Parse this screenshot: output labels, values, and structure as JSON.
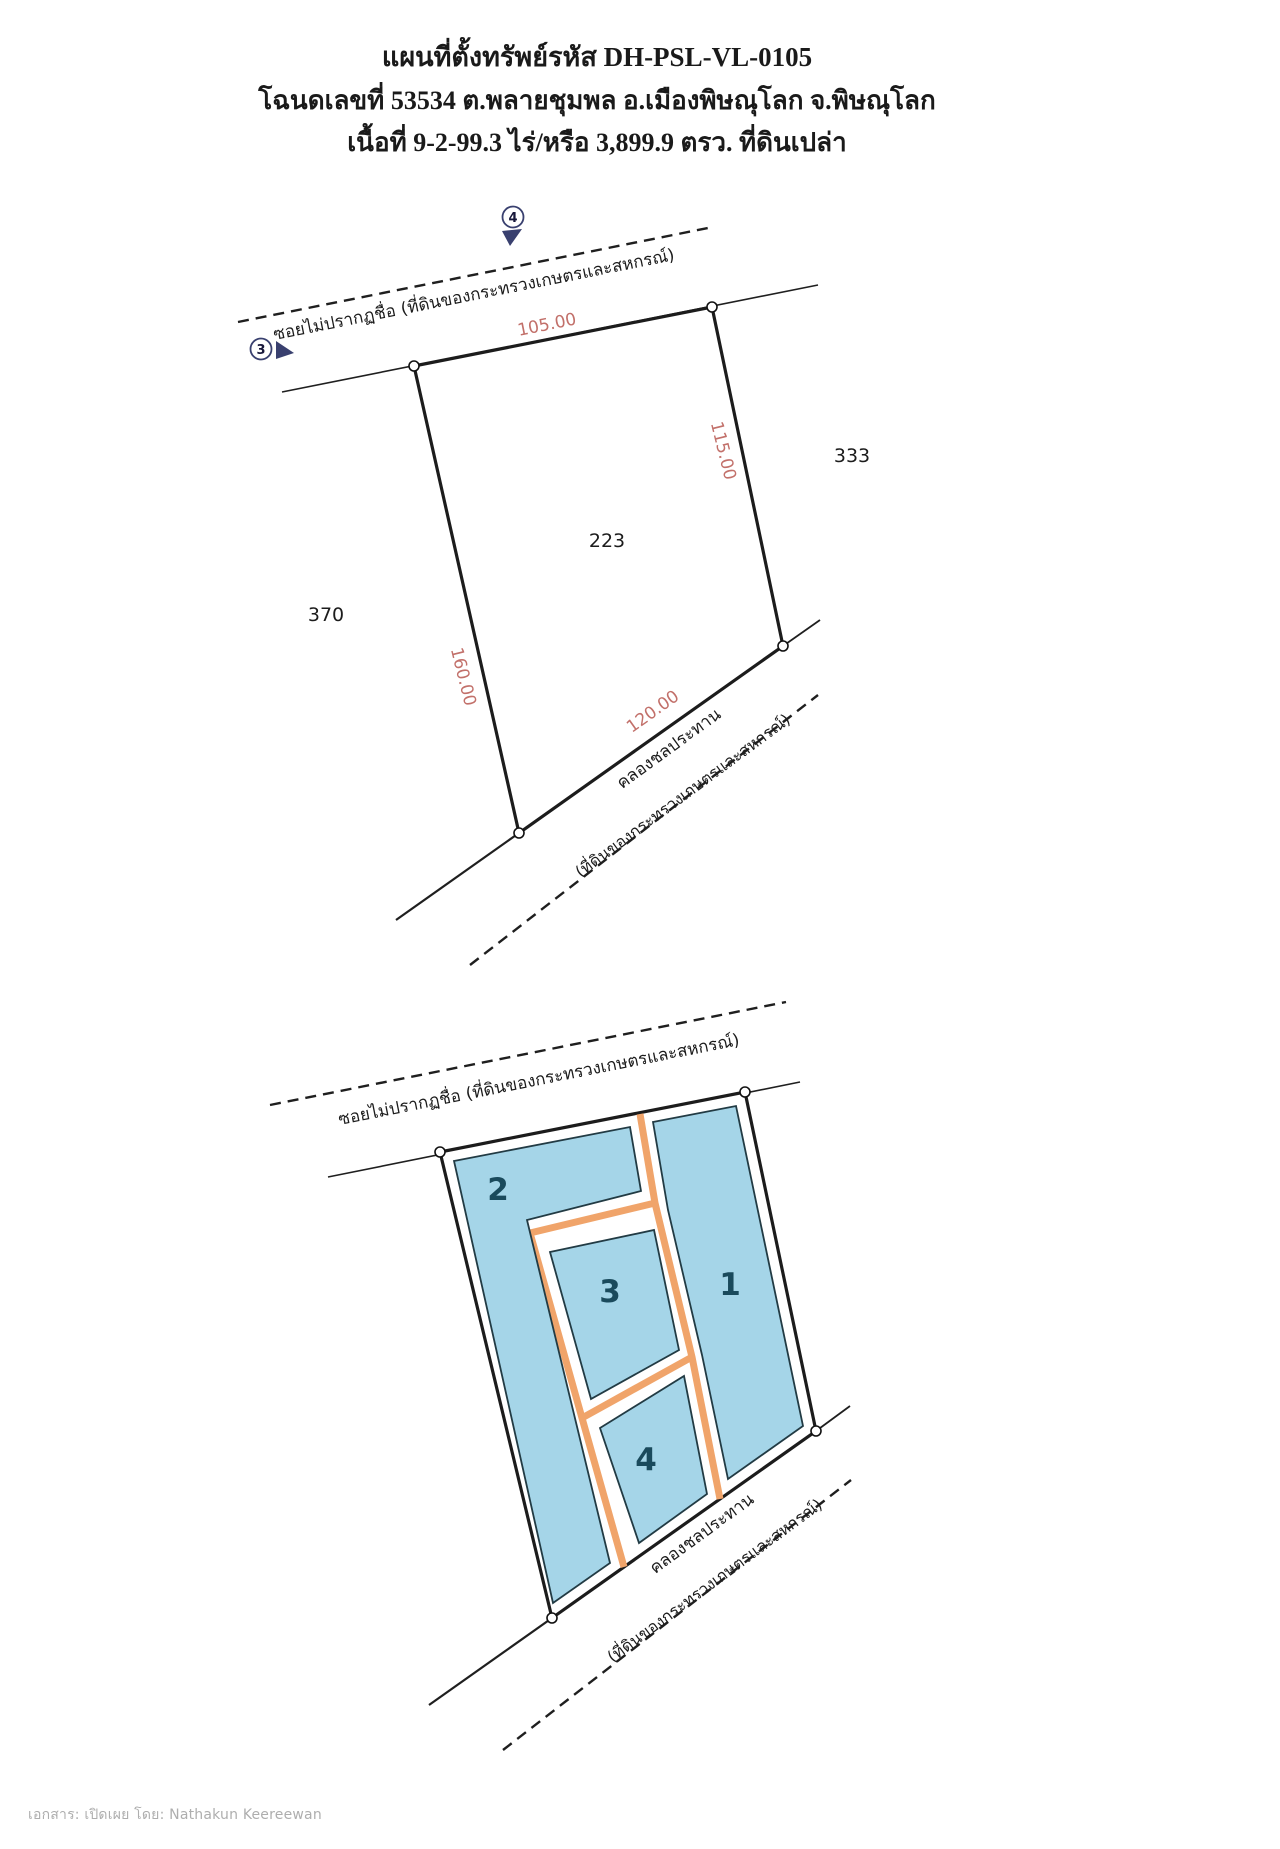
{
  "header": {
    "line1": "แผนที่ตั้งทรัพย์รหัส  DH-PSL-VL-0105",
    "line2": "โฉนดเลขที่ 53534 ต.พลายชุมพล อ.เมืองพิษณุโลก จ.พิษณุโลก",
    "line3": "เนื้อที่ 9-2-99.3 ไร่/หรือ 3,899.9 ตรว. ที่ดินเปล่า"
  },
  "diagram_top": {
    "road_label": "ซอยไม่ปรากฏชื่อ (ที่ดินของกระทรวงเกษตรและสหกรณ์)",
    "marker_3": "3",
    "marker_4": "4",
    "dim_top": "105.00",
    "dim_right": "115.00",
    "dim_left": "160.00",
    "dim_bottom": "120.00",
    "parcel_number": "223",
    "neighbor_right": "333",
    "neighbor_left": "370",
    "canal_label": "คลองชลประทาน",
    "canal_sublabel": "(ที่ดินของกระทรวงเกษตรและสหกรณ์)"
  },
  "diagram_bottom": {
    "road_label": "ซอยไม่ปรากฏชื่อ (ที่ดินของกระทรวงเกษตรและสหกรณ์)",
    "plots": [
      {
        "number": "1"
      },
      {
        "number": "2"
      },
      {
        "number": "3"
      },
      {
        "number": "4"
      }
    ],
    "canal_label": "คลองชลประทาน",
    "canal_sublabel": "(ที่ดินของกระทรวงเกษตรและสหกรณ์)"
  },
  "footer": {
    "text": "เอกสาร: เปิดเผย โดย: Nathakun Keereewan"
  },
  "colors": {
    "dimension_text": "#c2706a",
    "plot_fill": "#a5d5e8",
    "road_fill": "#f0a46a",
    "plot_number_text": "#1a4a5c",
    "boundary_line": "#1c1c1c",
    "marker_accent": "#39406f",
    "footer_text": "#aeaeae"
  }
}
